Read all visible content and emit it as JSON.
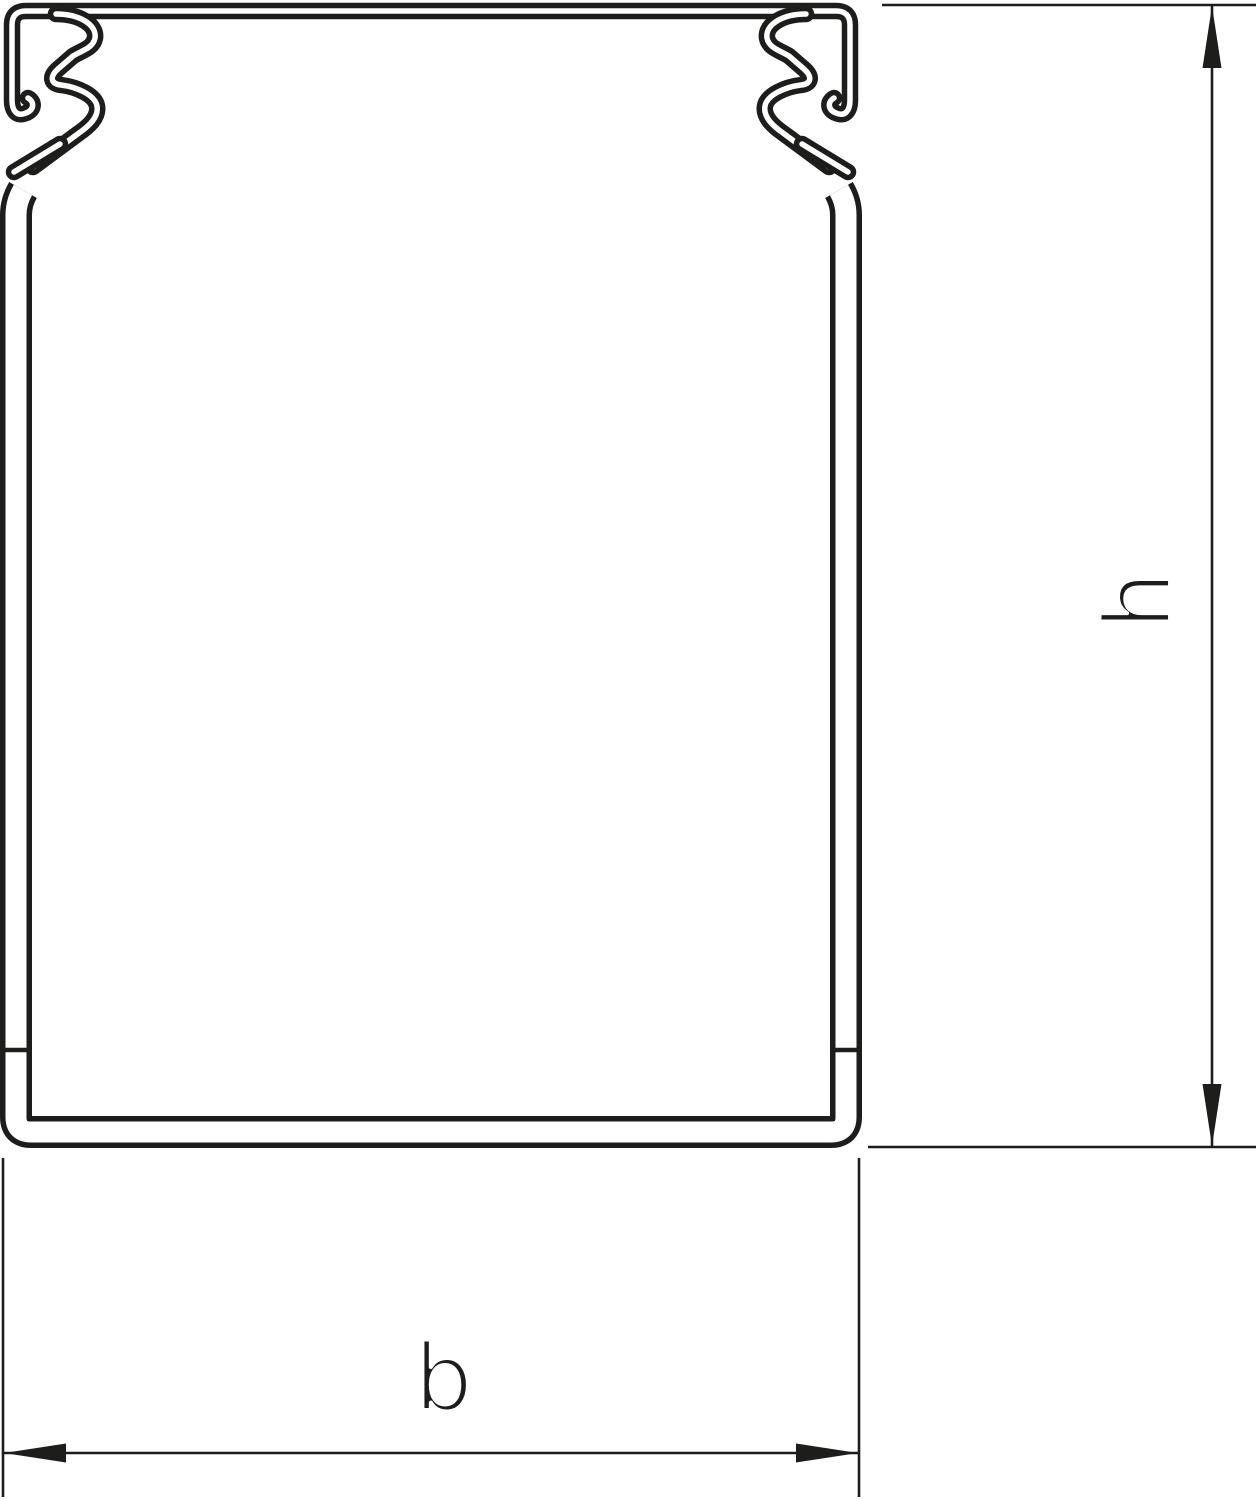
{
  "drawing": {
    "labels": {
      "height_dimension": "h",
      "width_dimension": "b"
    },
    "colors": {
      "line": "#1d1d1b",
      "background": "#ffffff"
    }
  }
}
